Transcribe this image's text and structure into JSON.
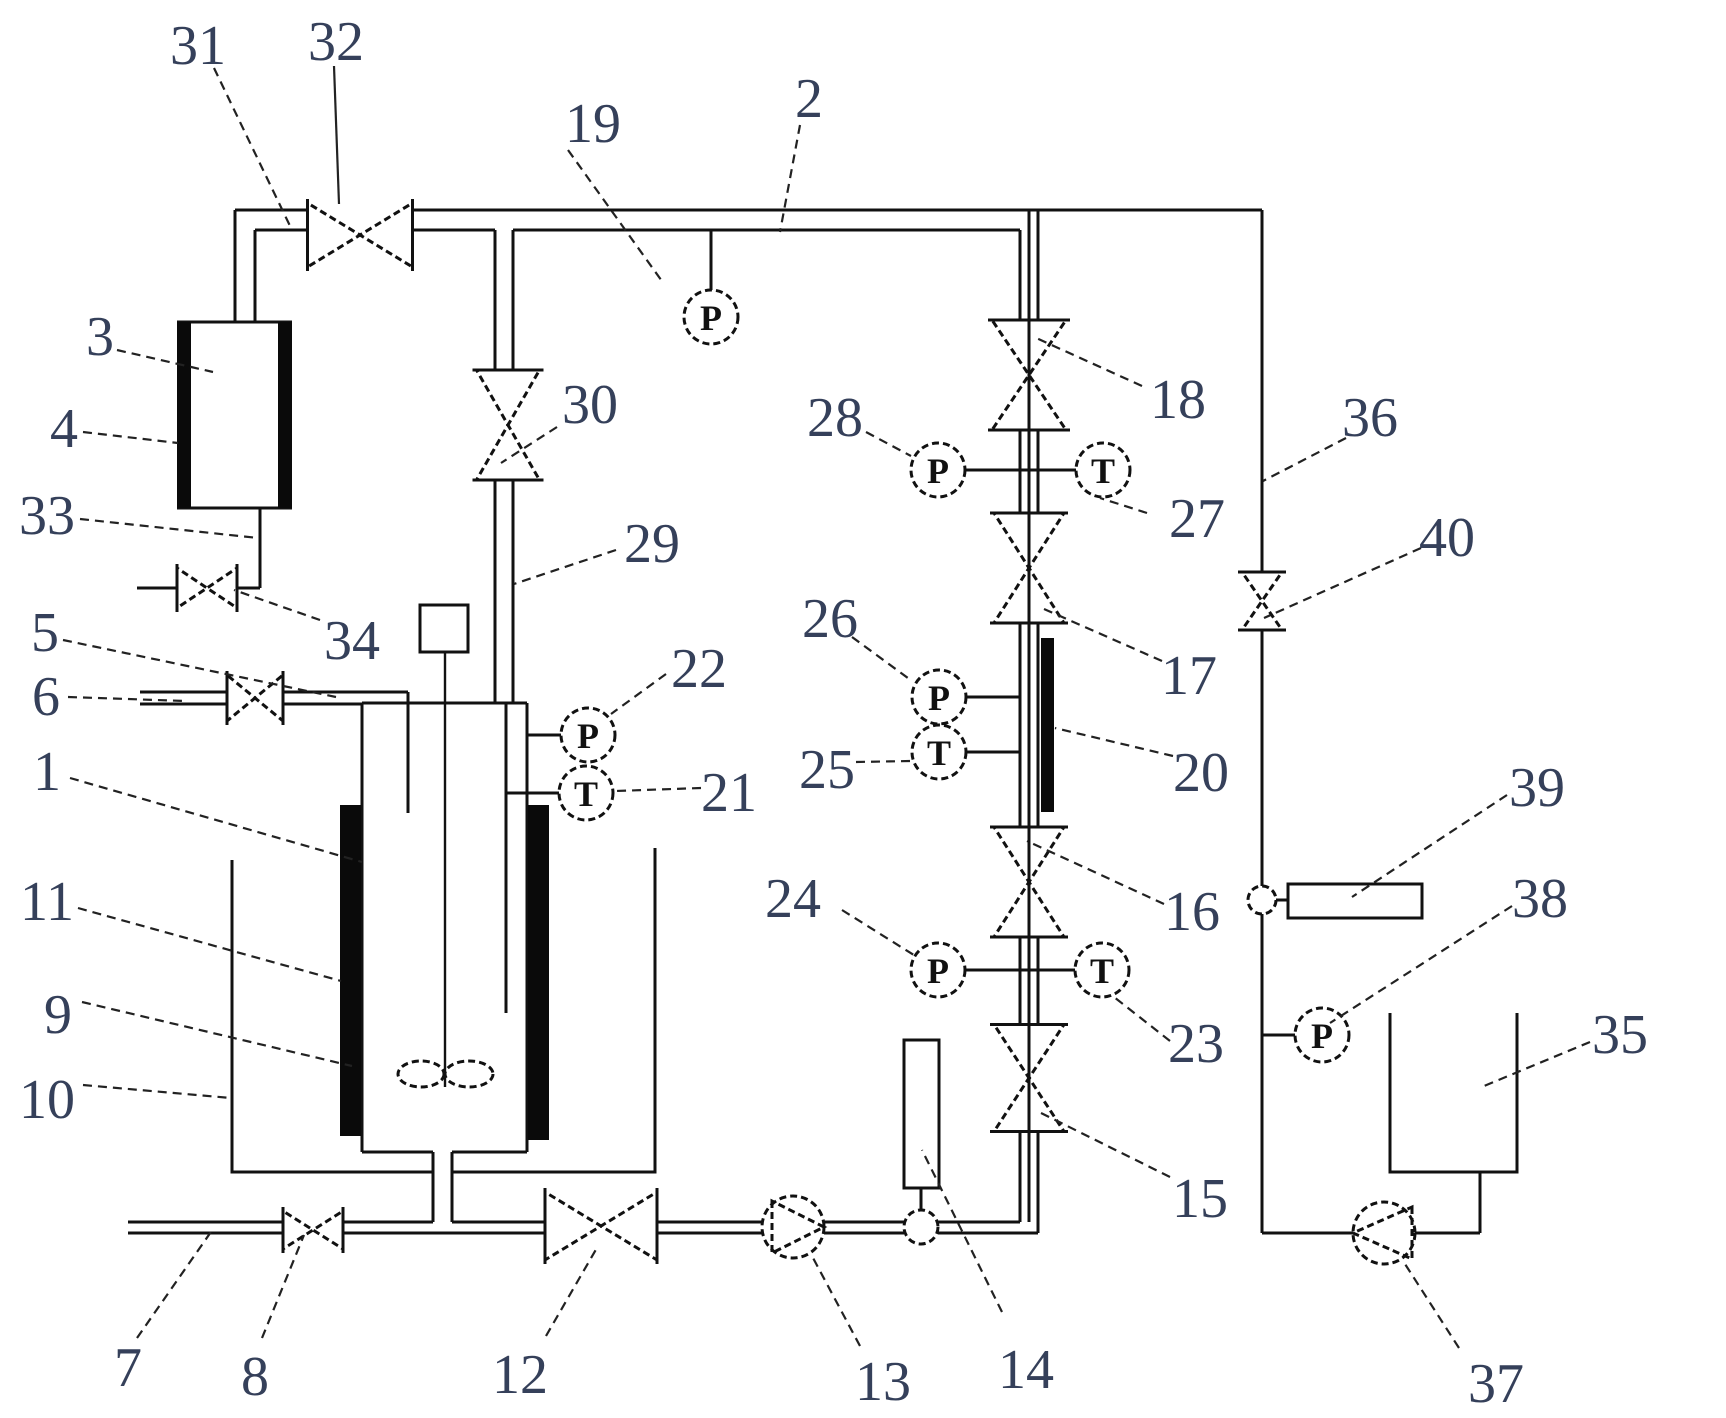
{
  "figure": {
    "background": "#ffffff",
    "line_color": "#111111",
    "label_color": "#35405a"
  },
  "labels": [
    {
      "text": "31",
      "x": 198,
      "y": 44,
      "leader": [
        214,
        68,
        291,
        228
      ]
    },
    {
      "text": "32",
      "x": 336,
      "y": 40,
      "leader": [
        334,
        66,
        339,
        204
      ],
      "solid": true
    },
    {
      "text": "19",
      "x": 593,
      "y": 122,
      "leader": [
        568,
        150,
        664,
        284
      ]
    },
    {
      "text": "2",
      "x": 809,
      "y": 97,
      "leader": [
        800,
        125,
        780,
        232
      ]
    },
    {
      "text": "3",
      "x": 100,
      "y": 335,
      "leader": [
        117,
        350,
        213,
        372
      ]
    },
    {
      "text": "4",
      "x": 64,
      "y": 427,
      "leader": [
        83,
        432,
        178,
        443
      ]
    },
    {
      "text": "33",
      "x": 47,
      "y": 514,
      "leader": [
        80,
        519,
        258,
        538
      ]
    },
    {
      "text": "34",
      "x": 352,
      "y": 639,
      "leader": [
        320,
        620,
        234,
        590
      ]
    },
    {
      "text": "5",
      "x": 45,
      "y": 631,
      "leader": [
        63,
        640,
        336,
        697
      ]
    },
    {
      "text": "6",
      "x": 46,
      "y": 695,
      "leader": [
        68,
        697,
        186,
        701
      ]
    },
    {
      "text": "1",
      "x": 47,
      "y": 770,
      "leader": [
        70,
        778,
        362,
        862
      ]
    },
    {
      "text": "11",
      "x": 47,
      "y": 900,
      "leader": [
        78,
        908,
        341,
        981
      ]
    },
    {
      "text": "9",
      "x": 58,
      "y": 1013,
      "leader": [
        82,
        1002,
        352,
        1066
      ]
    },
    {
      "text": "10",
      "x": 47,
      "y": 1098,
      "leader": [
        83,
        1085,
        231,
        1098
      ]
    },
    {
      "text": "7",
      "x": 128,
      "y": 1366,
      "leader": [
        137,
        1338,
        213,
        1229
      ]
    },
    {
      "text": "8",
      "x": 255,
      "y": 1375,
      "leader": [
        262,
        1338,
        304,
        1235
      ]
    },
    {
      "text": "12",
      "x": 520,
      "y": 1373,
      "leader": [
        546,
        1336,
        598,
        1246
      ]
    },
    {
      "text": "13",
      "x": 883,
      "y": 1380,
      "leader": [
        860,
        1346,
        812,
        1256
      ]
    },
    {
      "text": "14",
      "x": 1026,
      "y": 1368,
      "leader": [
        1002,
        1312,
        922,
        1150
      ]
    },
    {
      "text": "29",
      "x": 652,
      "y": 542,
      "leader": [
        616,
        550,
        514,
        584
      ]
    },
    {
      "text": "30",
      "x": 590,
      "y": 403,
      "leader": [
        557,
        427,
        501,
        463
      ]
    },
    {
      "text": "22",
      "x": 699,
      "y": 667,
      "leader": [
        666,
        674,
        611,
        714
      ]
    },
    {
      "text": "21",
      "x": 729,
      "y": 791,
      "leader": [
        701,
        788,
        616,
        791
      ]
    },
    {
      "text": "28",
      "x": 835,
      "y": 416,
      "leader": [
        866,
        432,
        911,
        456
      ]
    },
    {
      "text": "26",
      "x": 830,
      "y": 617,
      "leader": [
        852,
        637,
        912,
        681
      ]
    },
    {
      "text": "25",
      "x": 827,
      "y": 768,
      "leader": [
        856,
        762,
        911,
        761
      ]
    },
    {
      "text": "24",
      "x": 793,
      "y": 897,
      "leader": [
        842,
        910,
        917,
        957
      ]
    },
    {
      "text": "18",
      "x": 1178,
      "y": 398,
      "leader": [
        1142,
        386,
        1034,
        337
      ]
    },
    {
      "text": "27",
      "x": 1197,
      "y": 517,
      "leader": [
        1147,
        513,
        1100,
        498
      ]
    },
    {
      "text": "17",
      "x": 1189,
      "y": 674,
      "leader": [
        1162,
        661,
        1044,
        609
      ]
    },
    {
      "text": "20",
      "x": 1201,
      "y": 771,
      "leader": [
        1173,
        756,
        1055,
        728
      ]
    },
    {
      "text": "16",
      "x": 1192,
      "y": 910,
      "leader": [
        1164,
        904,
        1027,
        841
      ]
    },
    {
      "text": "23",
      "x": 1196,
      "y": 1042,
      "leader": [
        1170,
        1041,
        1114,
        997
      ]
    },
    {
      "text": "15",
      "x": 1200,
      "y": 1197,
      "leader": [
        1170,
        1177,
        1037,
        1111
      ]
    },
    {
      "text": "36",
      "x": 1370,
      "y": 416,
      "leader": [
        1346,
        438,
        1263,
        481
      ]
    },
    {
      "text": "40",
      "x": 1447,
      "y": 536,
      "leader": [
        1421,
        548,
        1264,
        618
      ]
    },
    {
      "text": "39",
      "x": 1537,
      "y": 786,
      "leader": [
        1507,
        795,
        1352,
        897
      ]
    },
    {
      "text": "38",
      "x": 1540,
      "y": 897,
      "leader": [
        1512,
        906,
        1330,
        1023
      ]
    },
    {
      "text": "35",
      "x": 1620,
      "y": 1033,
      "leader": [
        1590,
        1042,
        1484,
        1086
      ]
    },
    {
      "text": "37",
      "x": 1496,
      "y": 1382,
      "leader": [
        1459,
        1348,
        1405,
        1264
      ]
    }
  ],
  "gauges": [
    {
      "letter": "P",
      "name": "pressure-gauge-19",
      "x": 711,
      "y": 317
    },
    {
      "letter": "P",
      "name": "pressure-gauge-22",
      "x": 588,
      "y": 735
    },
    {
      "letter": "T",
      "name": "temperature-gauge-21",
      "x": 586,
      "y": 793
    },
    {
      "letter": "P",
      "name": "pressure-gauge-28",
      "x": 938,
      "y": 470
    },
    {
      "letter": "T",
      "name": "temperature-gauge-27",
      "x": 1103,
      "y": 470
    },
    {
      "letter": "P",
      "name": "pressure-gauge-26",
      "x": 939,
      "y": 697
    },
    {
      "letter": "T",
      "name": "temperature-gauge-25",
      "x": 939,
      "y": 752
    },
    {
      "letter": "P",
      "name": "pressure-gauge-24",
      "x": 938,
      "y": 970
    },
    {
      "letter": "T",
      "name": "temperature-gauge-23",
      "x": 1102,
      "y": 970
    },
    {
      "letter": "P",
      "name": "pressure-gauge-38",
      "x": 1322,
      "y": 1035
    }
  ],
  "valves": [
    {
      "name": "valve-32",
      "orient": "h",
      "cx": 360,
      "cy": 235,
      "w": 105,
      "h": 64
    },
    {
      "name": "valve-34",
      "orient": "h",
      "cx": 207,
      "cy": 588,
      "w": 60,
      "h": 40
    },
    {
      "name": "valve-6",
      "orient": "h",
      "cx": 255,
      "cy": 698,
      "w": 56,
      "h": 46
    },
    {
      "name": "valve-8",
      "orient": "h",
      "cx": 313,
      "cy": 1230,
      "w": 60,
      "h": 38
    },
    {
      "name": "valve-12",
      "orient": "h",
      "cx": 601,
      "cy": 1226,
      "w": 112,
      "h": 68
    },
    {
      "name": "valve-30",
      "orient": "v",
      "cx": 508,
      "cy": 425,
      "w": 63,
      "h": 110
    },
    {
      "name": "valve-18",
      "orient": "v",
      "cx": 1029,
      "cy": 375,
      "w": 74,
      "h": 110
    },
    {
      "name": "valve-17",
      "orient": "v",
      "cx": 1029,
      "cy": 568,
      "w": 70,
      "h": 110
    },
    {
      "name": "valve-16",
      "orient": "v",
      "cx": 1029,
      "cy": 882,
      "w": 70,
      "h": 110
    },
    {
      "name": "valve-15",
      "orient": "v",
      "cx": 1029,
      "cy": 1078,
      "w": 70,
      "h": 107
    },
    {
      "name": "valve-40",
      "orient": "v",
      "cx": 1262,
      "cy": 601,
      "w": 40,
      "h": 58
    }
  ],
  "pumps": [
    {
      "name": "pump-13",
      "cx": 793,
      "cy": 1227,
      "r": 31,
      "dir": "right"
    },
    {
      "name": "pump-37",
      "cx": 1384,
      "cy": 1233,
      "r": 31,
      "dir": "left"
    }
  ],
  "junctions": [
    {
      "name": "junction-flowmeter-tap",
      "cx": 921,
      "cy": 1227,
      "r": 17
    },
    {
      "name": "junction-line-36",
      "cx": 1262,
      "cy": 900,
      "r": 14
    }
  ],
  "instrument_boxes": [
    {
      "name": "flowmeter-14",
      "x": 904,
      "y": 1040,
      "w": 35,
      "h": 148
    },
    {
      "name": "instrument-39",
      "x": 1288,
      "y": 884,
      "w": 134,
      "h": 34
    }
  ]
}
